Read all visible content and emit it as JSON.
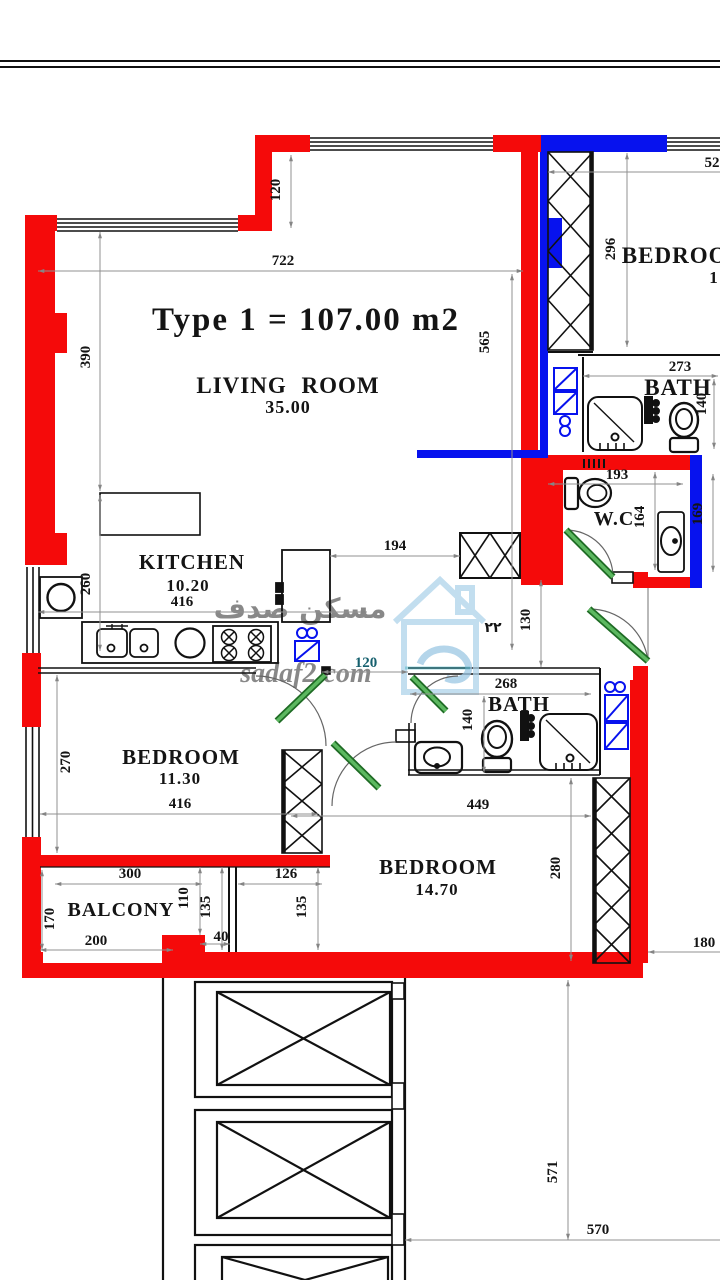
{
  "title": "Type 1 = 107.00 m2",
  "rooms": {
    "living": {
      "name": "LIVING  ROOM",
      "area": "35.00"
    },
    "kitchen": {
      "name": "KITCHEN",
      "area": "10.20"
    },
    "bedroom1": {
      "name": "BEDROOM",
      "area": "11.30"
    },
    "bedroom2": {
      "name": "BEDROOM",
      "area": "14.70"
    },
    "bedroom3": {
      "name": "BEDROOM",
      "area": "1"
    },
    "bath1": {
      "name": "BATH"
    },
    "bath2": {
      "name": "BATH"
    },
    "wc": {
      "name": "W.C"
    },
    "balcony": {
      "name": "BALCONY"
    }
  },
  "dimensions": {
    "w722": "722",
    "h390": "390",
    "h120": "120",
    "h565": "565",
    "h296": "296",
    "w52": "52",
    "w273": "273",
    "h140_bath1": "140",
    "w193": "193",
    "h164": "164",
    "h169": "169",
    "w194": "194",
    "h130": "130",
    "w120": "120",
    "w268": "268",
    "h140_bath2": "140",
    "h260": "260",
    "w416_kitchen": "416",
    "h270": "270",
    "w416_bedroom": "416",
    "w449": "449",
    "h280": "280",
    "w300": "300",
    "h110": "110",
    "h135_a": "135",
    "w40": "40",
    "w126": "126",
    "h135_b": "135",
    "h170": "170",
    "w200": "200",
    "w180": "180",
    "h571": "571",
    "w570": "570"
  },
  "watermark": {
    "arabic": "مسكن صدف",
    "site": "sadaf2.com",
    "marks": "٢٢"
  },
  "colors": {
    "wall_red": "#f50a0a",
    "wall_blue": "#0712ee",
    "door_green": "#4aa84e",
    "dim_gray": "#8a8a8a",
    "watermark_teal": "#2fa8bc"
  }
}
